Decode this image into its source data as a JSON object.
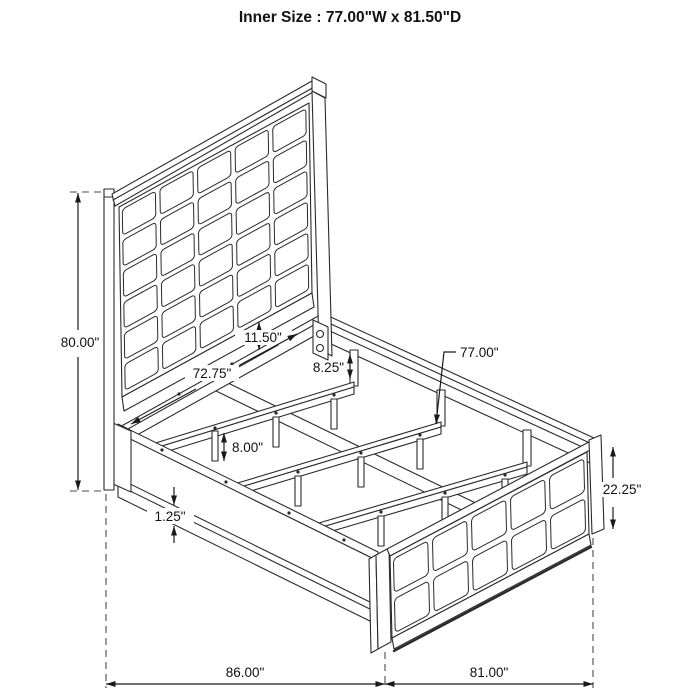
{
  "title": "Inner Size : 77.00\"W x 81.50\"D",
  "dims": {
    "headboard_height": "80.00\"",
    "panel_to_rail_gap": "11.50\"",
    "rail_inner_length": "72.75\"",
    "rail_to_slat_drop": "8.25\"",
    "slat_width": "77.00\"",
    "leg_height": "8.00\"",
    "rail_lip": "1.25\"",
    "footboard_height": "22.25\"",
    "overall_length": "86.00\"",
    "overall_width": "81.00\""
  },
  "drawing": {
    "line_color": "#2a2a2a",
    "dim_color": "#1a1a1a",
    "dash_color": "#4a4a4a",
    "background": "#ffffff",
    "headboard_grid": {
      "cols": 5,
      "rows": 6
    },
    "footboard_grid": {
      "cols": 5,
      "rows": 2
    }
  }
}
